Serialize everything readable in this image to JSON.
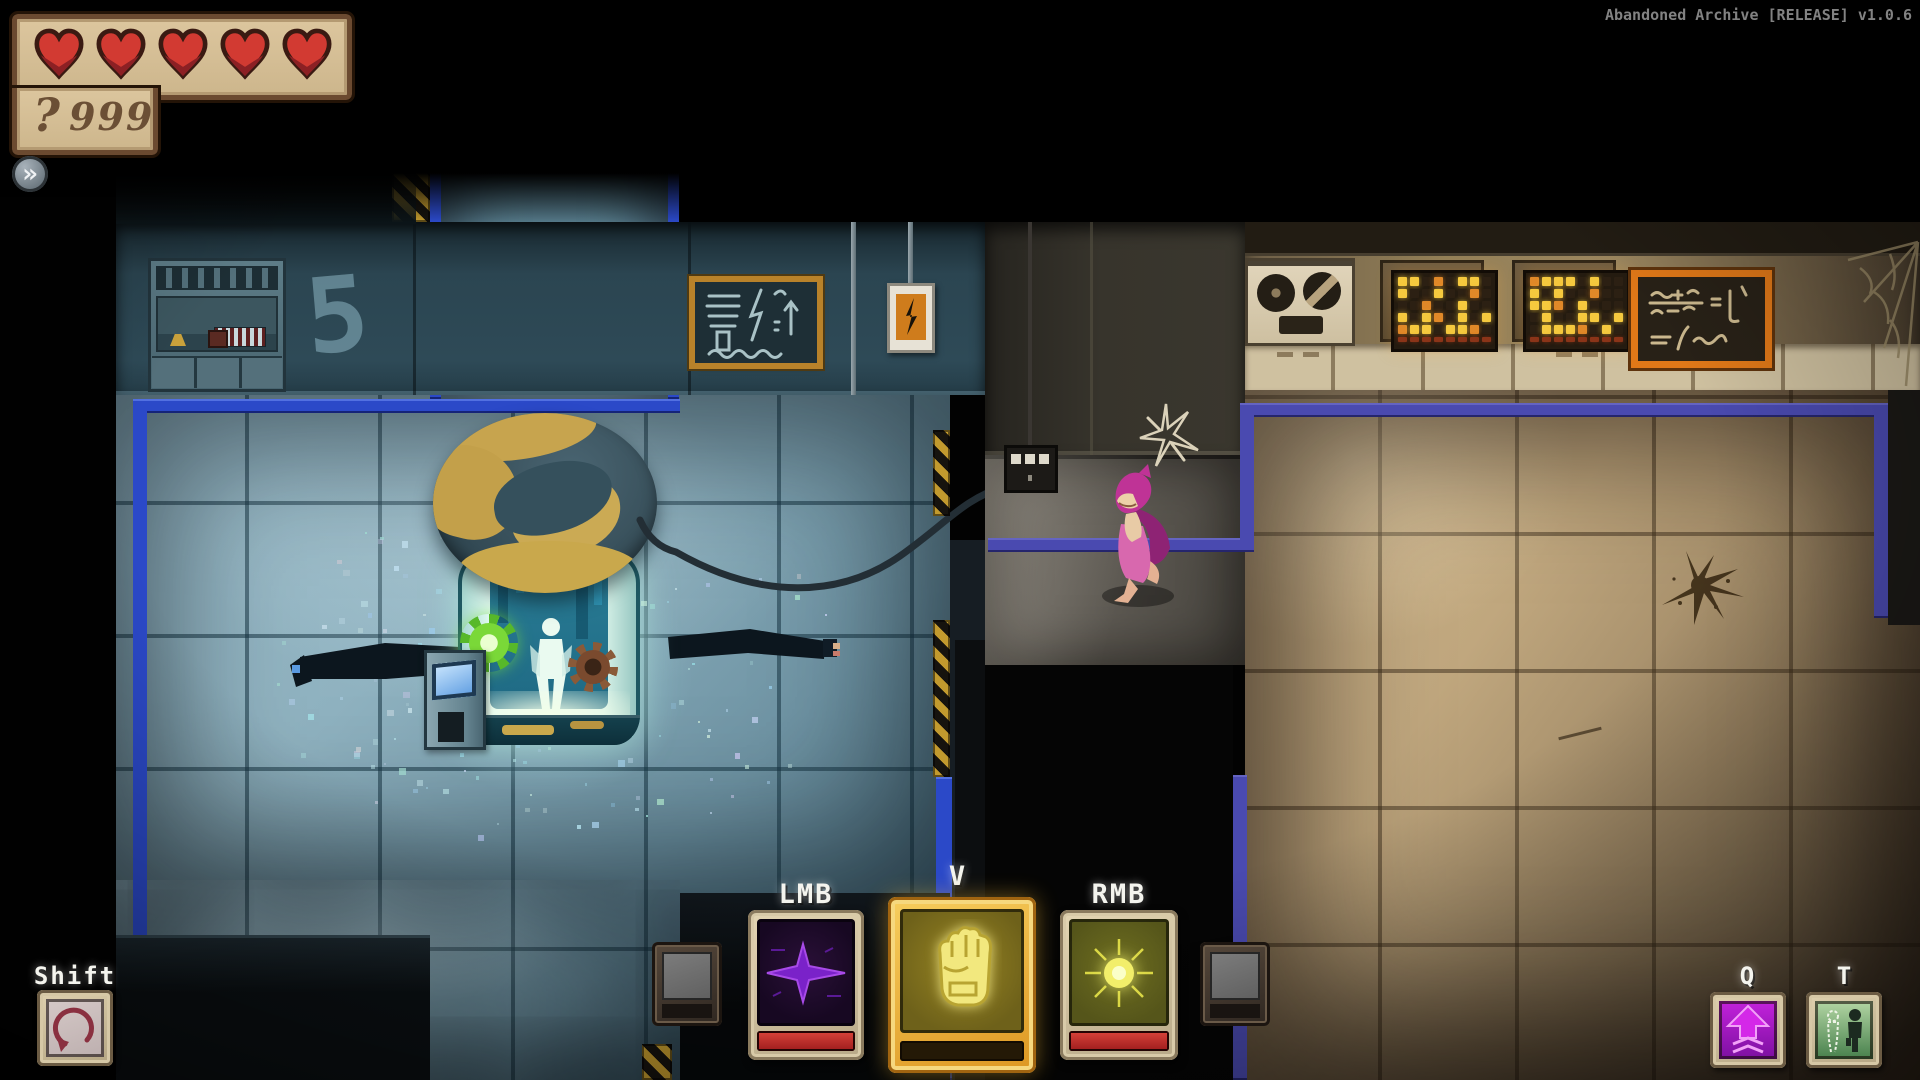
{
  "window": {
    "title": "Abandoned Archive [RELEASE] v1.0.6"
  },
  "hud": {
    "hearts_count": 5,
    "hearts_icon": "heart-icon",
    "currency": {
      "icon": "question-key-icon",
      "glyph": "?",
      "value": "999"
    },
    "expand_glyph": "»"
  },
  "hotbar": {
    "labels": {
      "lmb": "LMB",
      "v": "V",
      "rmb": "RMB",
      "shift": "Shift",
      "q": "Q",
      "t": "T"
    },
    "slots": {
      "lmb": {
        "icon": "purple-dart-icon",
        "bar": "red-full"
      },
      "v": {
        "icon": "fist-icon",
        "selected": true,
        "bar": "empty"
      },
      "rmb": {
        "icon": "energy-burst-icon",
        "bar": "red-full"
      },
      "shift": {
        "icon": "roll-dash-icon"
      },
      "q": {
        "icon": "upgrade-arrow-icon"
      },
      "t": {
        "icon": "swap-character-icon"
      }
    }
  },
  "scene": {
    "room_number_stencil": "5",
    "cryo_tube": "stasis-tank-with-globe-dome",
    "signs": {
      "chalkboard": "coil-lightning-arrow-diagram",
      "power_sign": "lightning-bolt-plate",
      "formula_board": "chalk-formula-board"
    },
    "displays": {
      "matrix_a": [
        "yy.o.yy.",
        "y..y..o.",
        "..o..y..",
        "y.yo.y.y",
        "oyy.yyo."
      ],
      "matrix_b": [
        "oyyy.y..",
        "y.y..o..",
        "yyo.y...",
        ".y..yy.y",
        ".yyyo.y."
      ],
      "matrix_dim_row": "rrrrrrrr"
    }
  },
  "colors": {
    "pipe_blue": "#2b49c8",
    "pipe_indigo": "#4a4ab0",
    "selected_gold": "#e8a229",
    "cooldown_red": "#c03030",
    "heart_red": "#d23a32",
    "hud_panel_tan": "#d6bf97",
    "hud_text_brown": "#6b4f35",
    "label_white": "#f4f4ee"
  }
}
